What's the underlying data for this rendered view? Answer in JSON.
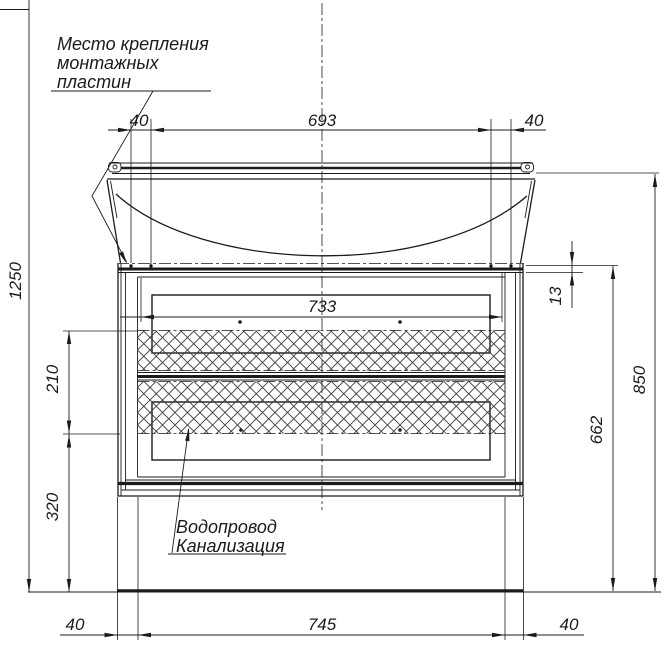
{
  "annotations": {
    "mounting_plates_note": {
      "line1": "Место крепления",
      "line2": "монтажных",
      "line3": "пластин"
    },
    "plumbing_note": {
      "line1": "Водопровод",
      "line2": "Канализация"
    }
  },
  "dimensions": {
    "top": {
      "left_offset": "40",
      "span": "693",
      "right_offset": "40"
    },
    "inner_width": "733",
    "countertop_thickness": "13",
    "left": {
      "overall_height": "1250",
      "drawer_zone": "210",
      "floor_clearance": "320"
    },
    "right": {
      "cabinet_height": "662",
      "overall_with_basin": "850"
    },
    "bottom": {
      "left_offset": "40",
      "span": "745",
      "right_offset": "40"
    }
  },
  "colors": {
    "line": "#1b1b1b",
    "background": "#ffffff"
  }
}
